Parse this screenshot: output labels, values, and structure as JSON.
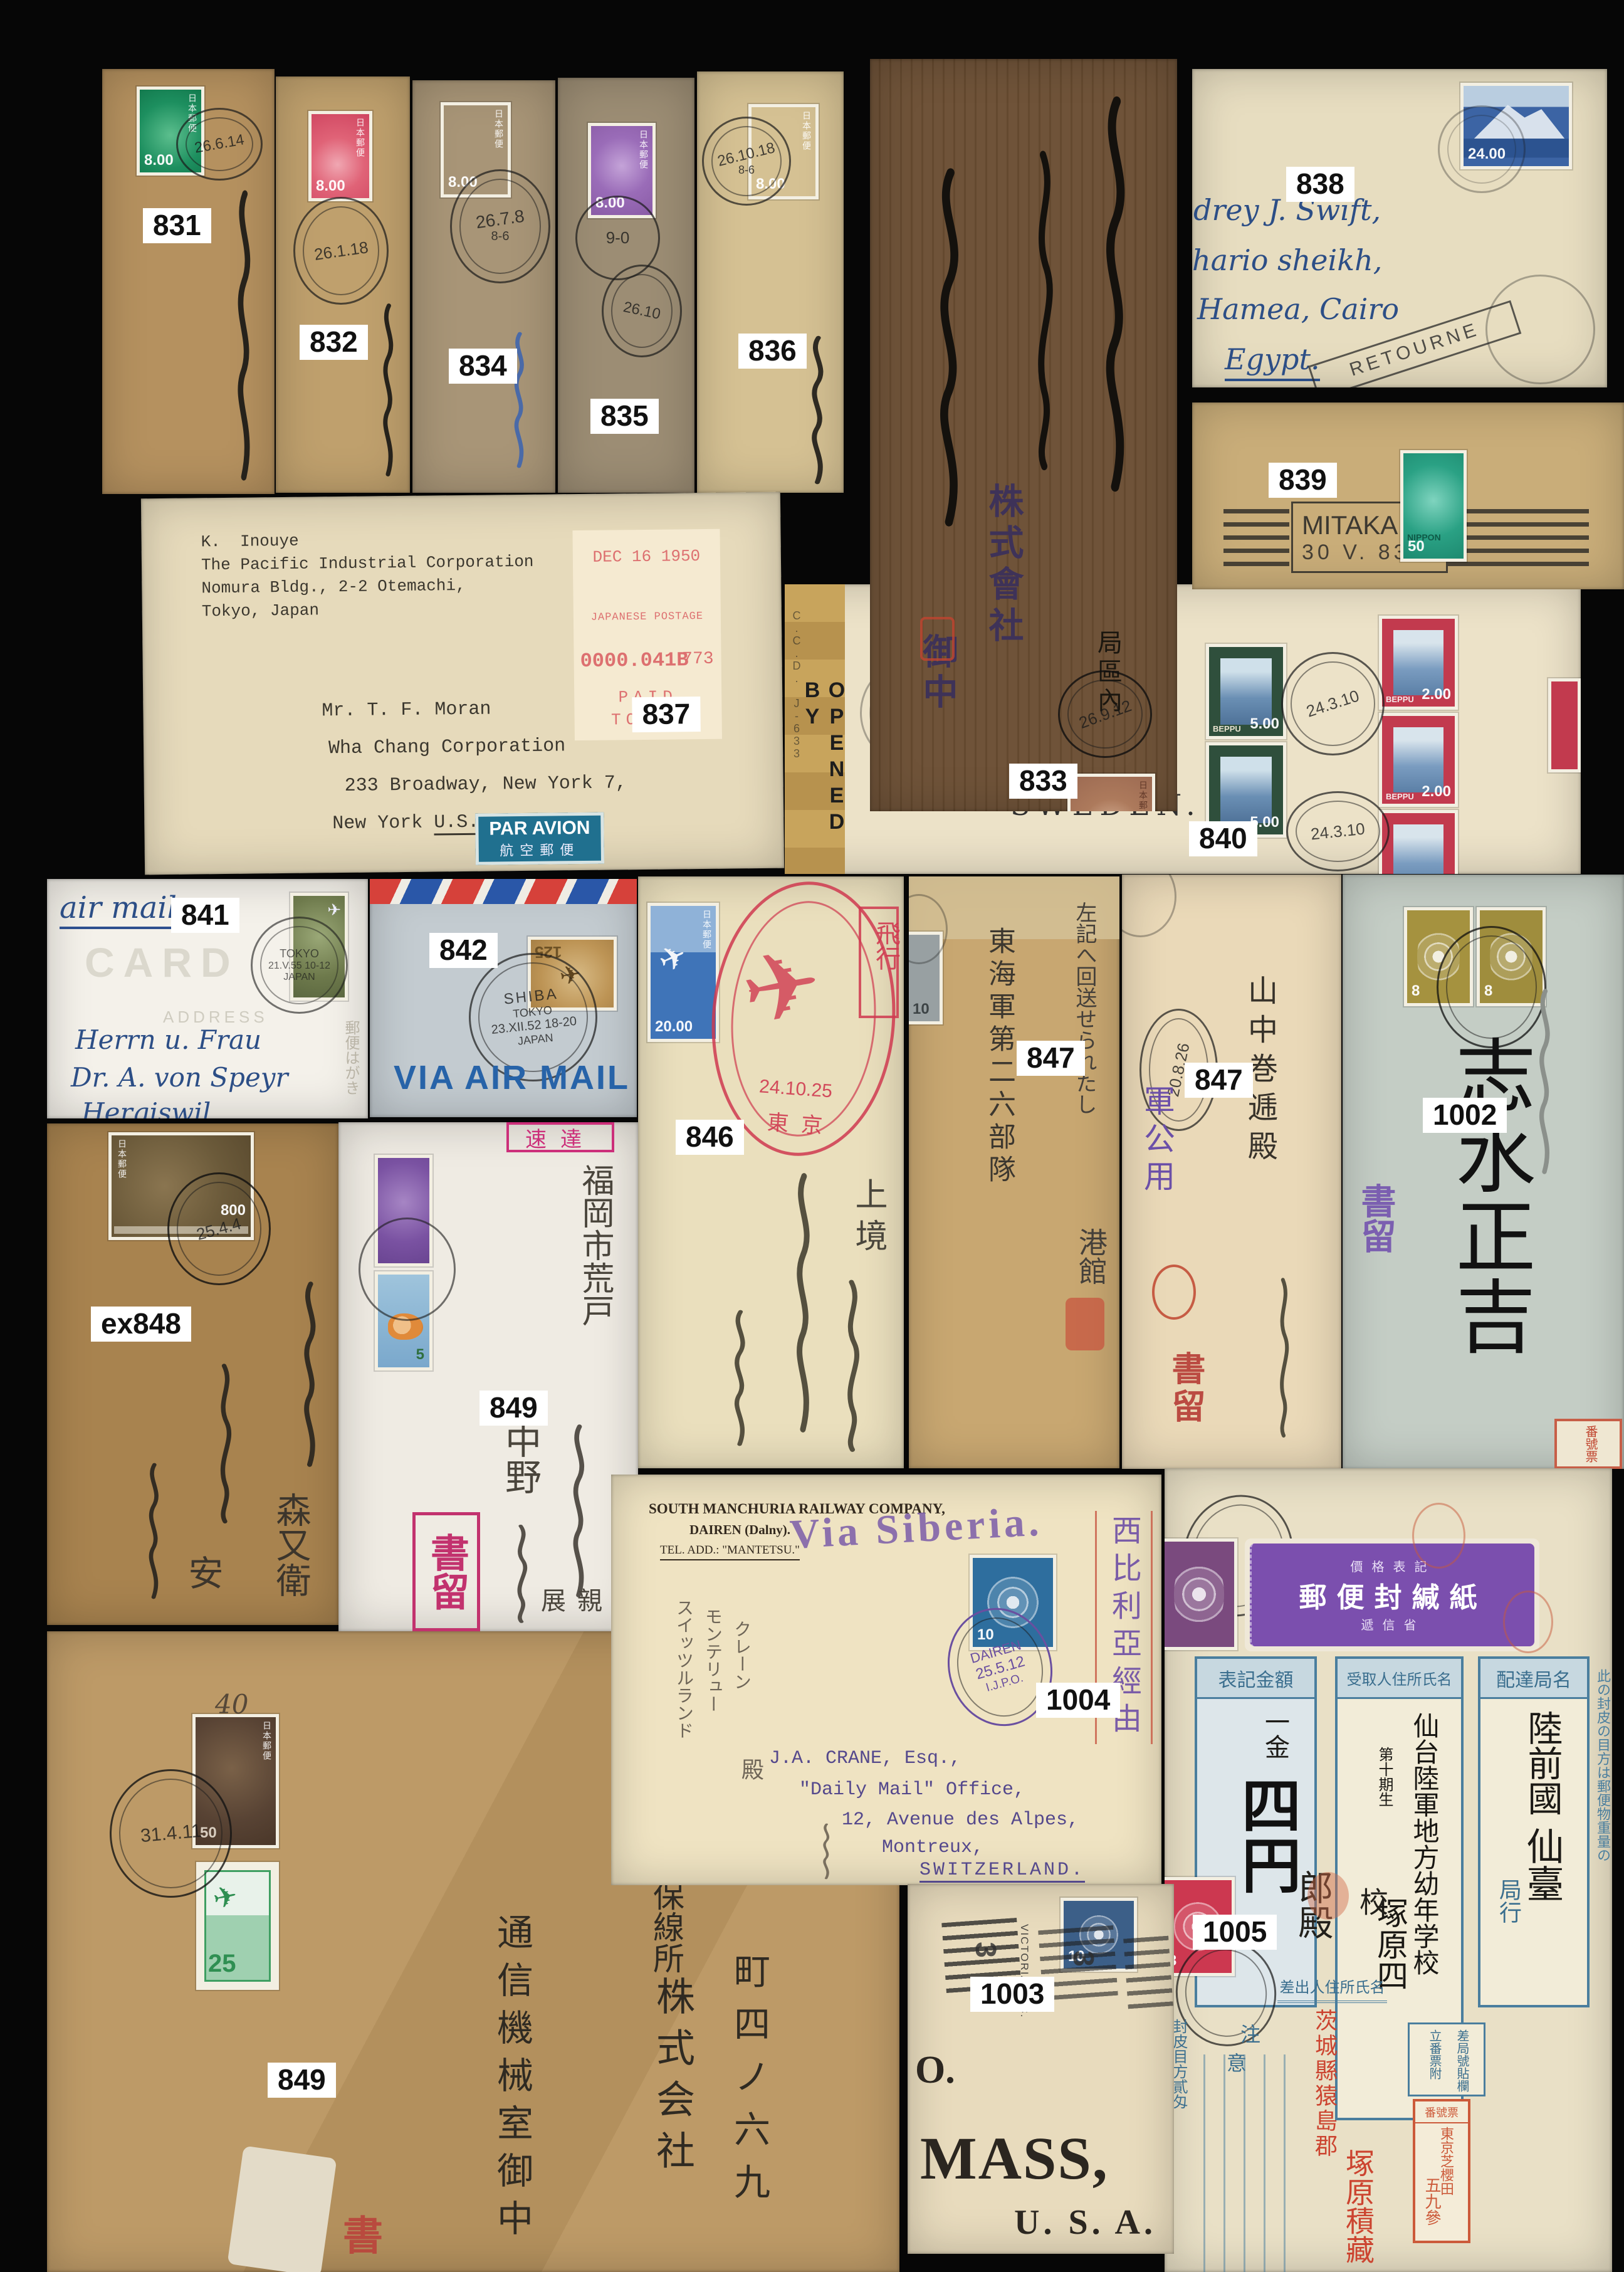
{
  "colors": {
    "background": "#060606",
    "label_background": "#ffffff",
    "label_text": "#111111",
    "par_avion_blue": "#20708f",
    "meter_red": "#dd7070",
    "registered_magenta": "#c2326e",
    "violet_handstamp": "#6a4fa0",
    "red_cancel": "#cf3a50",
    "form_blue": "#4a7e9e"
  },
  "common": {
    "jp_post": "日本郵便",
    "nippon": "NIPPON",
    "beppu": "BEPPU"
  },
  "lots": {
    "l831": "831",
    "l832": "832",
    "l833": "833",
    "l834": "834",
    "l835": "835",
    "l836": "836",
    "l837": "837",
    "l838": "838",
    "l839": "839",
    "l840": "840",
    "l841": "841",
    "l842": "842",
    "l846": "846",
    "l847a": "847",
    "l847b": "847",
    "l848": "ex848",
    "l849a": "849",
    "l849b": "849",
    "l1002": "1002",
    "l1003": "1003",
    "l1004": "1004",
    "l1005": "1005"
  },
  "covers": {
    "c831": {
      "stamp_value": "8.00",
      "cds": "26.6.14"
    },
    "c832": {
      "stamp_value": "8.00",
      "cds": "26.1.18"
    },
    "c833": {
      "stamp_value": "8.00",
      "cds": "26.9.12",
      "company": "株式會社",
      "honorific": "御中",
      "district": "局區內"
    },
    "c834": {
      "stamp_value": "8.00",
      "cds": "26.7.8",
      "cds_index": "8-6"
    },
    "c835": {
      "stamp_value": "8.00",
      "cds1": "9-0",
      "cds2": "26.10"
    },
    "c836": {
      "stamp_value": "8.00",
      "cds": "26.10.18",
      "cds_index": "8-6"
    },
    "c837": {
      "sender1": "K.  Inouye",
      "sender2": "The Pacific Industrial Corporation",
      "sender3": "Nomura Bldg., 2-2 Otemachi,",
      "sender4": "Tokyo, Japan",
      "meter_date": "DEC 16 1950",
      "meter_line": "JAPANESE POSTAGE",
      "meter_value": "0000.041B",
      "meter_serial": "773",
      "meter_paid": "PAID",
      "meter_city": "TOKYO",
      "addr1": "Mr. T. F. Moran",
      "addr2": "Wha Chang Corporation",
      "addr3": "233 Broadway, New York 7,",
      "addr4": "New York",
      "addr4b": "U.S.A.",
      "par_avion": "PAR AVION",
      "par_avion_jp": "航空郵便"
    },
    "c838": {
      "stamp_value": "24.00",
      "addr1": "drey J. Swift,",
      "addr2": "hario sheikh,",
      "addr3": "Hamea, Cairo",
      "addr4": "Egypt.",
      "handstamp": "RETOURNE"
    },
    "c839": {
      "town": "MITAKA",
      "date": "30 V. 83",
      "stamp_value": "50"
    },
    "c840": {
      "censor": "OPENED BY",
      "censor2": "C.C.D. J-633",
      "dest1": "Falun,",
      "dest2": "SWEDEN.",
      "cds": "24.3.10",
      "green_value": "5.00",
      "red_value": "2.00"
    },
    "c841": {
      "script": "air mail",
      "card": "CARD",
      "address_label": "ADDRESS",
      "cds1": "TOKYO",
      "cds2": "21.V.55 10-12",
      "cds3": "JAPAN",
      "addr1": "Herrn u. Frau",
      "addr2": "Dr. A. von Speyr",
      "addr3": "Hergiswil",
      "note": "郵便はがき"
    },
    "c842": {
      "cds1": "SHIBA",
      "cds2": "TOKYO",
      "cds3": "23.XII.52 18-20",
      "cds4": "JAPAN",
      "stamp_value": "125",
      "via": "VIA AIR MAIL"
    },
    "c846": {
      "stamp_value": "20.00",
      "cancel_date": "24.10.25",
      "cancel_city": "東京",
      "red_box": "飛行",
      "script": "上境"
    },
    "c847a": {
      "stamp_value": "10",
      "note": "左記へ回送せられたし",
      "unit": "東海軍第二六部隊",
      "port": "港館"
    },
    "c847b": {
      "official": "軍公用",
      "cds": "20.8.26",
      "name": "山中巻逓殿",
      "registered": "書留"
    },
    "c1002": {
      "stamp_value": "8",
      "registered": "書留",
      "name": "志水正吉",
      "tag": "番號票"
    },
    "c848": {
      "stamp_value": "800",
      "cds": "25.4.4",
      "name": "森又衛",
      "name2": "安"
    },
    "c849a": {
      "express": "速達",
      "registered": "書留",
      "city": "福岡市荒戸",
      "name": "中野",
      "confidential": "親展",
      "duck_value": "5"
    },
    "c849b": {
      "pencil": "40",
      "stamp1_value": "50",
      "stamp2_value": "25",
      "cds": "31.4.11",
      "registered": "書留",
      "col1": "通信機械室御中",
      "col2": "株式会社",
      "col3": "町四ノ六九",
      "col4": "静岡保線所"
    },
    "c1003": {
      "stamp_value": "10",
      "cancel_city": "VICTORIA, B.C.",
      "digit": "3",
      "line1": "O.",
      "line2": "MASS,",
      "line3": "U. S. A."
    },
    "c1004": {
      "corner1": "SOUTH MANCHURIA RAILWAY COMPANY,",
      "corner2": "DAIREN (Dalny).",
      "corner3": "TEL. ADD.: \"MANTETSU.\"",
      "via": "Via Siberia.",
      "route": "西比利亞經由",
      "cds1": "DAIREN",
      "cds2": "25.5.12",
      "cds3": "I.J.P.O.",
      "stamp_value": "10",
      "addr1": "J.A. CRANE, Esq.,",
      "addr2": "\"Daily Mail\" Office,",
      "addr3": "12, Avenue des Alpes,",
      "addr4": "Montreux,",
      "addr5": "SWITZERLAND.",
      "pencil1": "スイッツルランド",
      "pencil2": "モンテリュー",
      "pencil3": "クレーン",
      "pencil4": "殿"
    },
    "c1005": {
      "seal_top": "價格表記",
      "seal_main": "郵便封緘紙",
      "seal_bottom": "遞信省",
      "colR_header": "配達局名",
      "colR1": "陸前國",
      "colR2": "仙臺",
      "colR3": "局行",
      "colM_header": "受取人住所氏名",
      "colM1": "仙台陸軍地方幼年学校",
      "colM2": "第十期生",
      "colM3": "塚原四",
      "colL_header": "表記金額",
      "colL1": "一金",
      "colL2": "四円",
      "cont1": "郎殿",
      "cont2": "校",
      "sender_header": "差出人住所氏名",
      "sender1": "茨城縣猿島郡",
      "sender2": "塚原積藏",
      "notice": "注意",
      "weight": "封皮目方貳匁",
      "right_note": "此の封皮の目方は郵便物重量の",
      "tag_h1": "差局號貼欄",
      "tag_h2": "立番票附",
      "tag_title": "番號票",
      "tag1": "東京芝櫻田",
      "tag2": "五九參",
      "stamp_red": "3"
    }
  }
}
